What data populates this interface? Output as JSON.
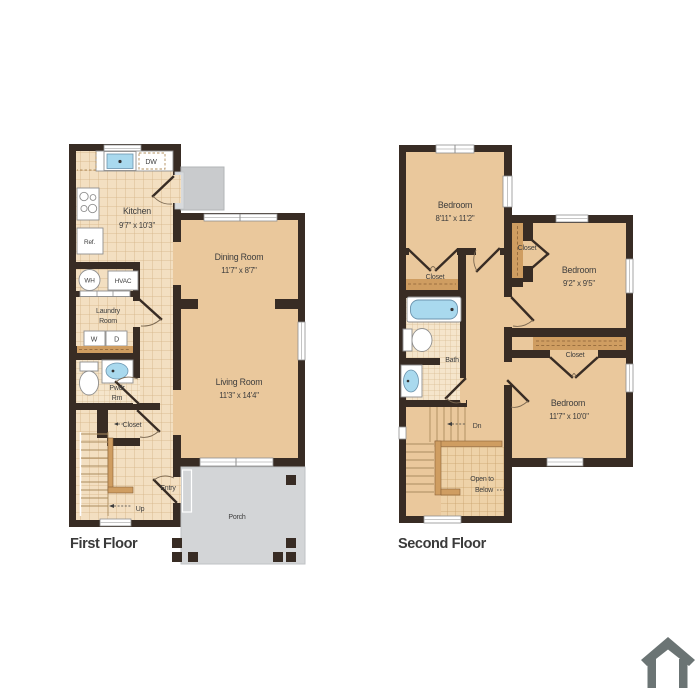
{
  "colors": {
    "wall": "#382c24",
    "room_fill": "#eac89c",
    "tile_fill": "#f3dfc1",
    "closet_brown": "#cf9d61",
    "porch_gray": "#d3d5d7",
    "stoop_gray": "#c9cbcd",
    "water_blue": "#a9d9ee",
    "text": "#3d3d3d",
    "icon_gray": "#6b7474"
  },
  "icons": {
    "logo": "house-icon"
  },
  "first_floor": {
    "label": "First Floor",
    "kitchen": {
      "name": "Kitchen",
      "dims": "9'7\" x 10'3\""
    },
    "dining": {
      "name": "Dining Room",
      "dims": "11'7\" x 8'7\""
    },
    "living": {
      "name": "Living Room",
      "dims": "11'3\" x 14'4\""
    },
    "laundry": {
      "line1": "Laundry",
      "line2": "Room"
    },
    "powder": {
      "line1": "Pwdr",
      "line2": "Rm"
    },
    "closet": "Closet",
    "entry": "Entry",
    "up": "Up",
    "porch": "Porch",
    "dw": "DW",
    "ref": "Ref.",
    "wh": "WH",
    "hvac": "HVAC",
    "washer": "W",
    "dryer": "D"
  },
  "second_floor": {
    "label": "Second Floor",
    "bedroom1": {
      "name": "Bedroom",
      "dims": "8'11\" x 11'2\""
    },
    "bedroom2": {
      "name": "Bedroom",
      "dims": "9'2\" x 9'5\""
    },
    "bedroom3": {
      "name": "Bedroom",
      "dims": "11'7\" x 10'0\""
    },
    "closet1": "Closet",
    "closet2": "Closet",
    "closet3": "Closet",
    "bath": "Bath",
    "dn": "Dn",
    "open_below": {
      "line1": "Open to",
      "line2": "Below"
    }
  }
}
